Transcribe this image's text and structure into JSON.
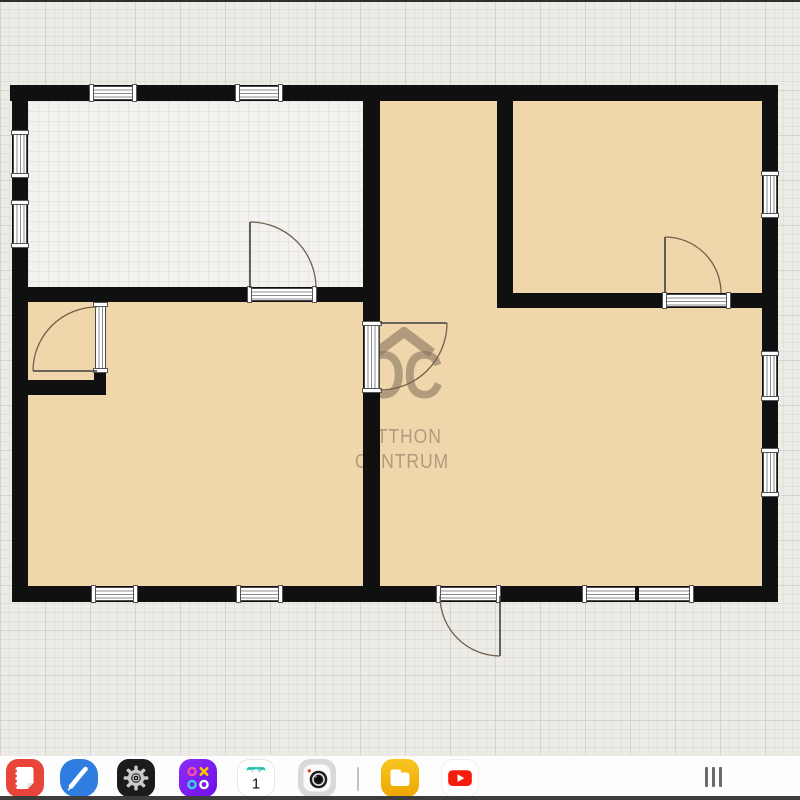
{
  "watermark": {
    "logo": "OC",
    "line1": "OTTHON",
    "line2": "CENTRUM"
  },
  "floorplan": {
    "wall_color": "#101010",
    "room_fill": "#f0d6ab",
    "empty_room_fill": "#f3f2ee",
    "paper_color": "#edebe6",
    "watermark_color": "rgba(124,110,88,0.55)"
  },
  "dock": {
    "background": "#fdfdfd",
    "apps": [
      {
        "name": "notes",
        "icon": "notes-icon",
        "color": "#e8443a"
      },
      {
        "name": "pen",
        "icon": "pen-icon",
        "color": "#2f7de1"
      },
      {
        "name": "settings",
        "icon": "settings-gear-icon",
        "color": "#1b1b1d"
      },
      {
        "name": "game",
        "icon": "ox-game-icon",
        "color": "#7f1bf5"
      },
      {
        "name": "calendar",
        "icon": "calendar-icon",
        "color": "#1fbfae",
        "header": "HÉT",
        "day": "1"
      },
      {
        "name": "camera",
        "icon": "camera-icon",
        "color": "#d9d9d9"
      },
      {
        "name": "my-files",
        "icon": "folder-icon",
        "color": "#f5b91a"
      },
      {
        "name": "youtube",
        "icon": "youtube-icon",
        "color": "#f61c0d"
      }
    ],
    "handle_icon": "drag-handle"
  }
}
